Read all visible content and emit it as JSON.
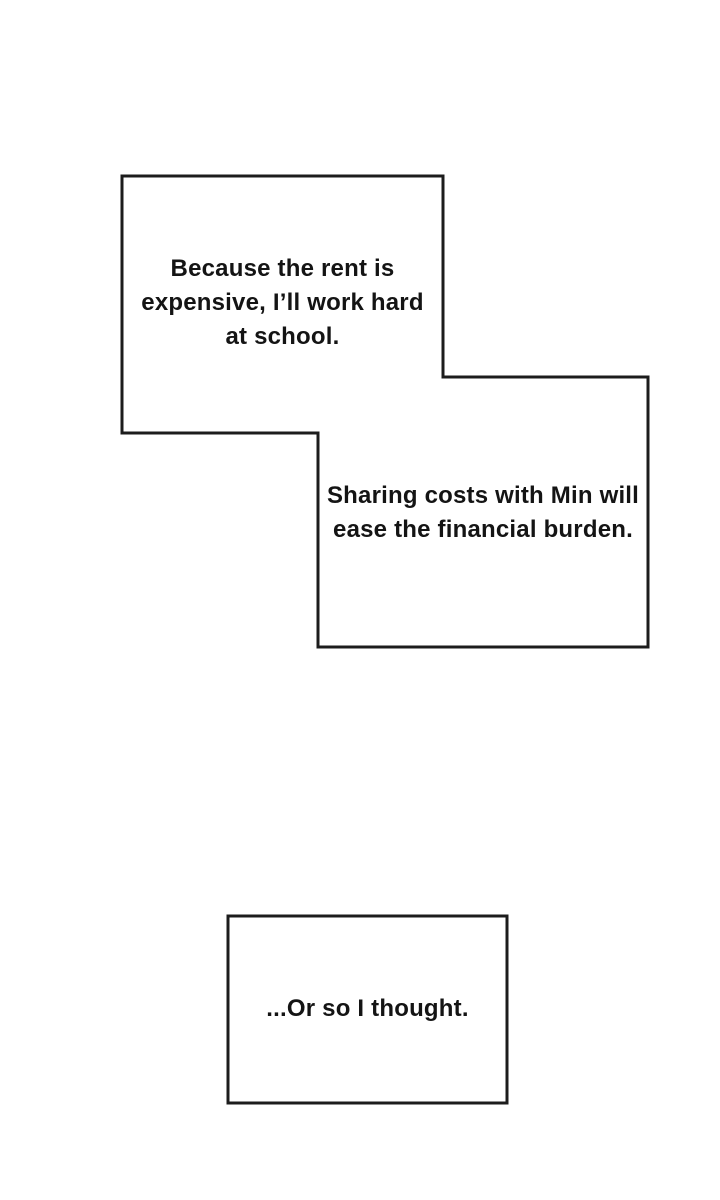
{
  "colors": {
    "background": "#ffffff",
    "line": "#1c1c1c",
    "text": "#141414"
  },
  "boxes": {
    "box1": {
      "lines": [
        "Because the rent is",
        "expensive, I’ll work hard",
        "at school."
      ]
    },
    "box2": {
      "lines": [
        "Sharing costs with Min will",
        "ease the financial burden."
      ]
    },
    "box3": {
      "lines": [
        "...Or so I thought."
      ]
    }
  }
}
